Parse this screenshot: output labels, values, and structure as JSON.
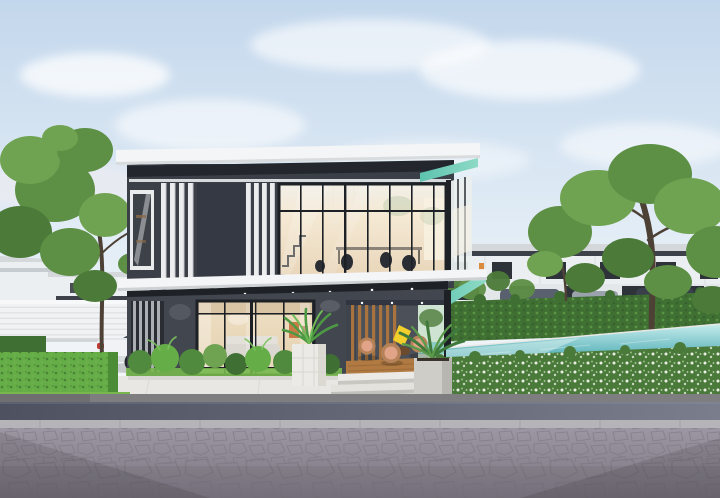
{
  "scene": {
    "type": "3d-architectural-rendering",
    "subject": "Modern two-storey charcoal-and-white house with glass curtain walls, covered wooden terrace, landscaped hedges, turquoise infinity pool, parked white SUV and block-paved street",
    "alt": "Photorealistic rendering of a modern two-storey house: white flat roof slab with mint soffit, dark charcoal walls, white vertical louvers, large warm-lit glass walls, open terrace with round wicker chairs, white planters, green hedges and trees, turquoise pool at right, white SUV parked at left behind a trimmed hedge, gray paved road in the foreground under a soft blue sky"
  },
  "colors": {
    "sky_top": "#c3d7ec",
    "sky_mid": "#e3edf6",
    "sky_horizon": "#f5f7f8",
    "wall_dark": "#3a3f48",
    "wall_panel": "#343943",
    "wall_ground": "#41464f",
    "wall_recess": "#23272d",
    "roof_white": "#f4f5f6",
    "trim_white": "#e9ebed",
    "soffit_mint": "#8edac6",
    "soffit_mint_deep": "#5cc3ae",
    "soffit_dark": "#1e2126",
    "mullion": "#1d2126",
    "glass_warm": "#f5e9d4",
    "glass_warm_deep": "#e9d6ba",
    "glass_cool": "#eef2f2",
    "slat_white": "#eaecee",
    "louver_gray": "#b9bcc0",
    "wood": "#a8733f",
    "deck": "#b07a42",
    "chair_wood": "#b5825a",
    "cushion": "#e2a488",
    "table_dark": "#6b4a2e",
    "accent_yellow": "#f2cf2b",
    "planter_white": "#eceae6",
    "planter_concrete": "#cfcdc8",
    "pool_light": "#c6ecec",
    "pool_deep": "#37a0aa",
    "pool_edge": "#1d6f79",
    "pool_tile": "#57b8be",
    "hedge_dark": "#3f6f33",
    "hedge_mid": "#4f8a3e",
    "hedge_bright": "#65ad47",
    "grass": "#77b74e",
    "flower_green": "#4a7a3a",
    "flower_white": "#f2f4ee",
    "tree_green": "#5d8f45",
    "tree_green_light": "#6fa351",
    "tree_green_dark": "#4c7a39",
    "trunk": "#4d4136",
    "fence_white": "#f0f2f4",
    "bg_wall": "#eceff1",
    "bg_band": "#3d424a",
    "bg_window": "#2e333a",
    "bg_roof": "#d5d8db",
    "bg_accent_orange": "#d98a3f",
    "car_white": "#f0f2f5",
    "car_window": "#454b55",
    "tire": "#24272b",
    "rim": "#9aa0a6",
    "tail_red": "#c23b34",
    "walkway": "#e8e7e3",
    "sidewalk": "#bdbcba",
    "curb": "#7e7d80",
    "asphalt_dark": "#4e5260",
    "asphalt_light": "#7a7e8c",
    "paver": "#b6b4b8",
    "road_light": "#9d97a3",
    "road_dark": "#7b7581",
    "stone_line": "#78727e",
    "interior_dark": "#2a2d33"
  }
}
